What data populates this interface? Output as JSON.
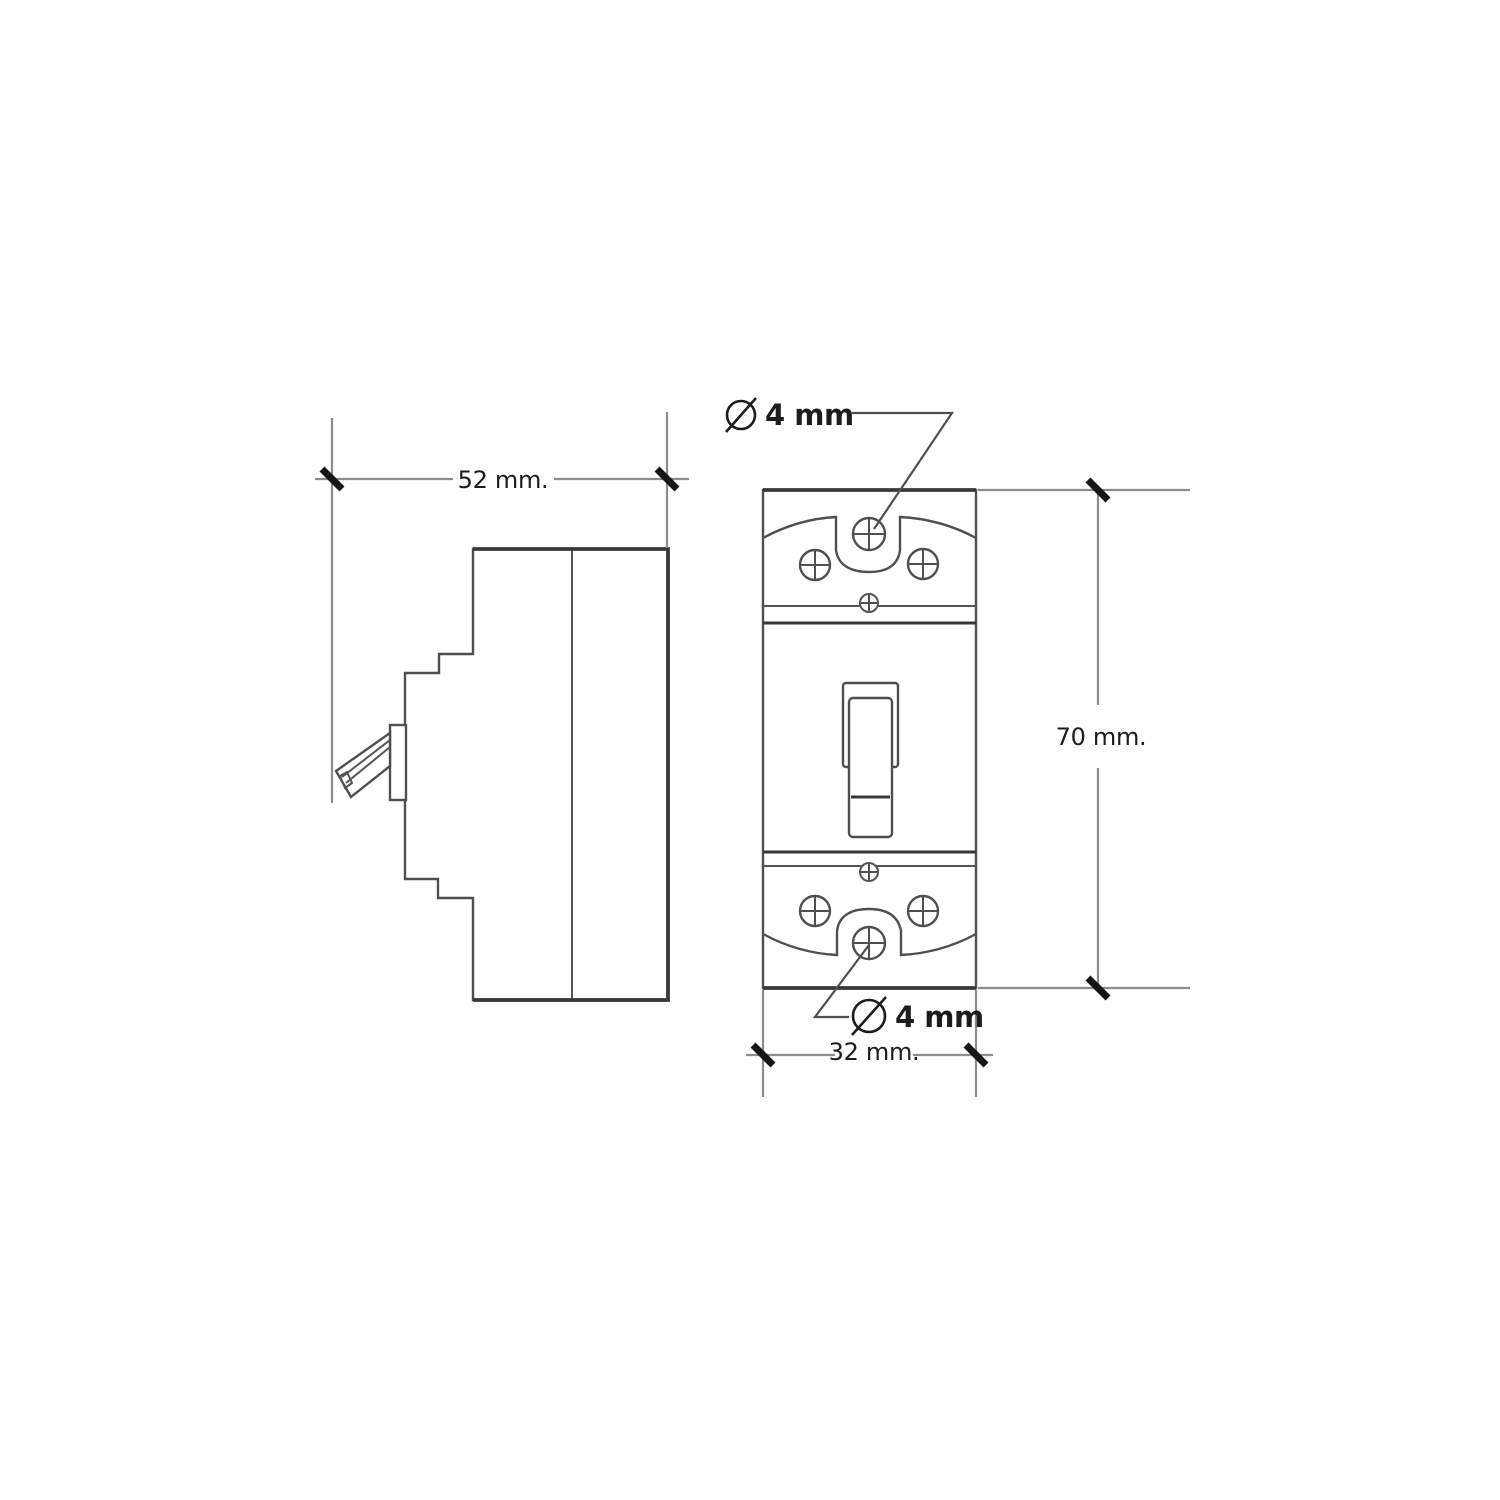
{
  "drawing": {
    "dimensions": {
      "side_width": {
        "label": "52 mm.",
        "value": 52,
        "unit": "mm"
      },
      "front_height": {
        "label": "70 mm.",
        "value": 70,
        "unit": "mm"
      },
      "front_width": {
        "label": "32 mm.",
        "value": 32,
        "unit": "mm"
      },
      "mount_hole_top": {
        "symbol": "Ø",
        "label": "4 mm",
        "value": 4,
        "unit": "mm"
      },
      "mount_hole_bottom": {
        "symbol": "Ø",
        "label": "4 mm",
        "value": 4,
        "unit": "mm"
      }
    }
  },
  "colors": {
    "background": "#ffffff",
    "outline": "#4f4f4f",
    "outline_strong": "#383838",
    "detail": "#555555",
    "dim_line": "#8c8c8c",
    "tick": "#161616",
    "leader": "#4f4f4f",
    "text": "#1c1c1c"
  }
}
